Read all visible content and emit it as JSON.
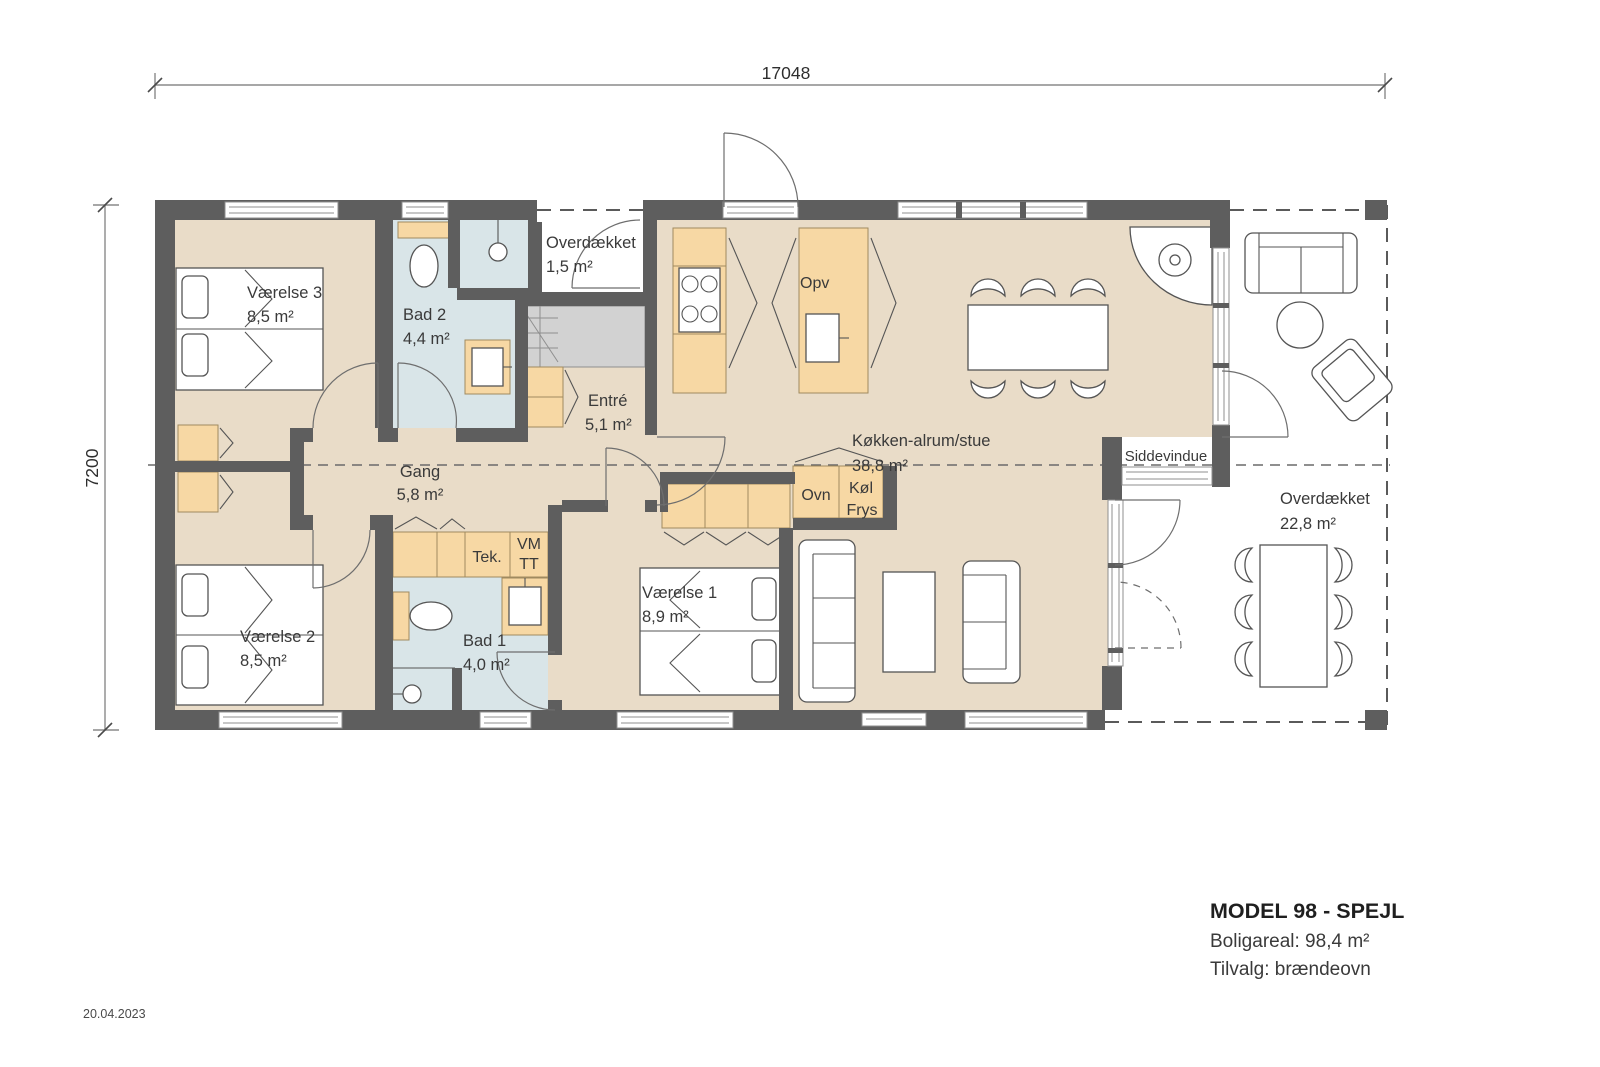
{
  "meta": {
    "date": "20.04.2023"
  },
  "dimensions": {
    "width_mm": "17048",
    "depth_mm": "7200"
  },
  "title_block": {
    "title": "MODEL 98 - SPEJL",
    "area_line": "Boligareal: 98,4 m²",
    "option_line": "Tilvalg: brændeovn"
  },
  "rooms": {
    "vaerelse3": {
      "name": "Værelse 3",
      "area": "8,5 m²"
    },
    "bad2": {
      "name": "Bad 2",
      "area": "4,4 m²"
    },
    "overdaekket_entry": {
      "name": "Overdækket",
      "area": "1,5 m²"
    },
    "entre": {
      "name": "Entré",
      "area": "5,1 m²"
    },
    "gang": {
      "name": "Gang",
      "area": "5,8 m²"
    },
    "koekken": {
      "name": "Køkken-alrum/stue",
      "area": "38,8 m²"
    },
    "vaerelse2": {
      "name": "Værelse 2",
      "area": "8,5 m²"
    },
    "bad1": {
      "name": "Bad 1",
      "area": "4,0 m²"
    },
    "vaerelse1": {
      "name": "Værelse 1",
      "area": "8,9 m²"
    },
    "overdaekket_terrace": {
      "name": "Overdækket",
      "area": "22,8 m²"
    }
  },
  "fixtures": {
    "opv": "Opv",
    "ovn": "Ovn",
    "koel": "Køl",
    "frys": "Frys",
    "tek": "Tek.",
    "vm": "VM",
    "tt": "TT",
    "siddevindue": "Siddevindue"
  },
  "colors": {
    "wall": "#5e5e5e",
    "floor": "#e9dcc8",
    "wet_room": "#d9e5e8",
    "cabinet": "#f7d8a4",
    "closet_gray": "#d2d2d2",
    "line": "#555555"
  }
}
